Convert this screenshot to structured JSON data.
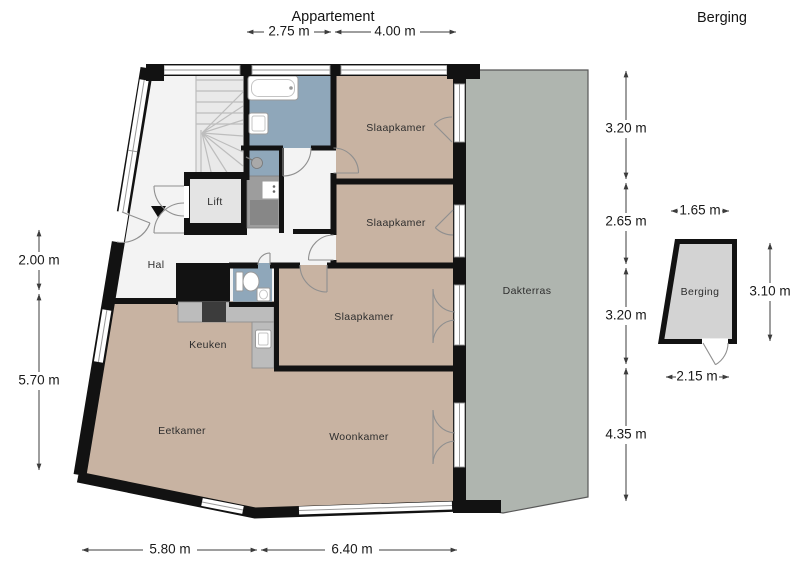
{
  "titles": {
    "apartment": "Appartement",
    "storage": "Berging"
  },
  "rooms": {
    "slaapkamer_1": "Slaapkamer",
    "slaapkamer_2": "Slaapkamer",
    "slaapkamer_3": "Slaapkamer",
    "lift": "Lift",
    "hal": "Hal",
    "keuken": "Keuken",
    "eetkamer": "Eetkamer",
    "woonkamer": "Woonkamer",
    "dakterras": "Dakterras",
    "berging": "Berging"
  },
  "dimensions": {
    "top": [
      "2.75 m",
      "4.00 m"
    ],
    "right": [
      "3.20 m",
      "2.65 m",
      "3.20 m",
      "4.35 m"
    ],
    "left": [
      "2.00 m",
      "5.70 m"
    ],
    "bottom": [
      "5.80 m",
      "6.40 m"
    ],
    "berging_top": "1.65 m",
    "berging_right": "3.10 m",
    "berging_bottom": "2.15 m"
  },
  "colors": {
    "wall": "#121212",
    "room_tan": "#c8b3a2",
    "wet_blue": "#8fa7ba",
    "terrace_gray": "#afb5af",
    "berging_gray": "#d3d3d3",
    "hall_white": "#f3f3f3",
    "lift_gray": "#e4e4e4",
    "counter_gray": "#bcbcbc",
    "stove_dark": "#3c3c3c",
    "shaft_gray": "#9d9d9d",
    "stair_gray": "#e9e9e9",
    "tread_gray": "#bdbdbd",
    "frame_gray": "#9a9a9a",
    "door_arc": "#8f8f8f",
    "dim_line": "#3c3c3c",
    "text_dark": "#191919"
  }
}
